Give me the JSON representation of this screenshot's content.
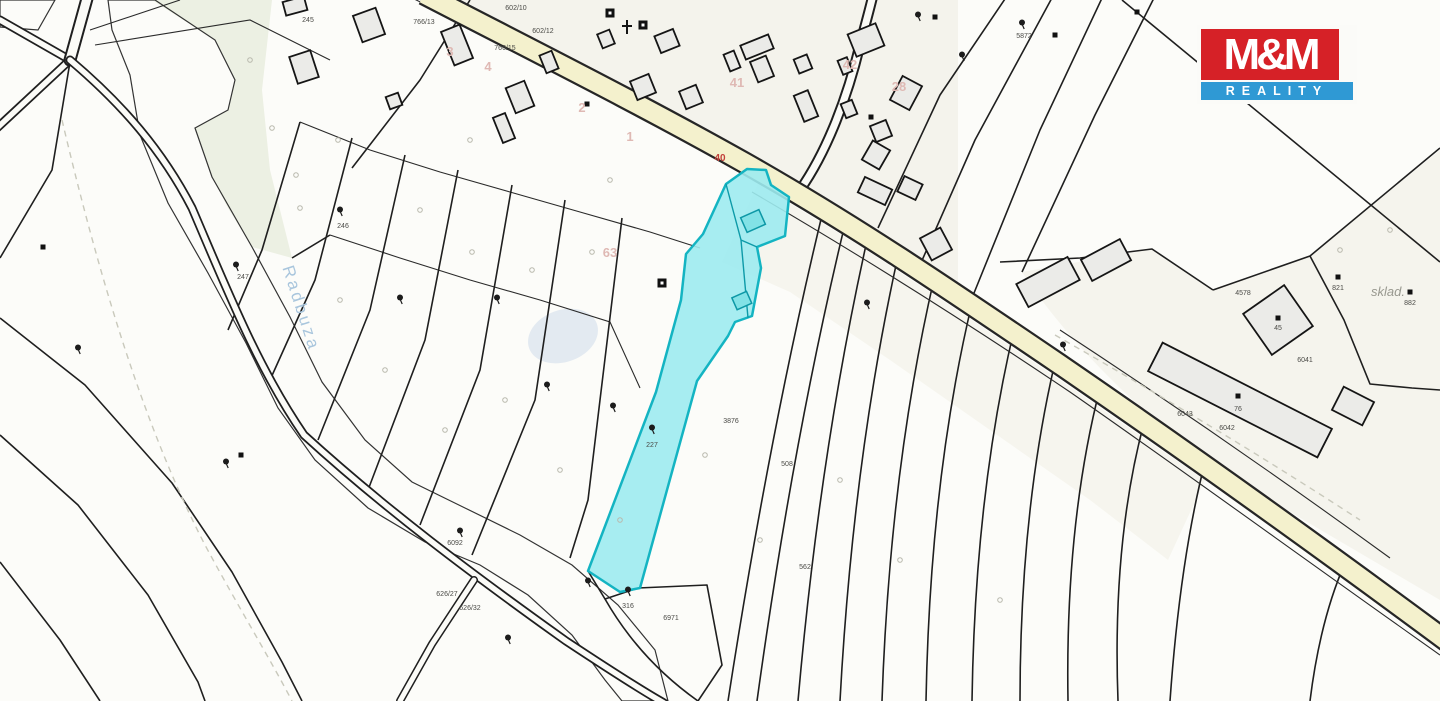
{
  "logo": {
    "top": "M&M",
    "bottom": "REALITY",
    "red": "#d62127",
    "blue": "#2f99d4"
  },
  "map": {
    "labels": {
      "river": "Radbuza",
      "warehouse": "sklad."
    },
    "colors": {
      "highlight_fill": "#9debef",
      "highlight_stroke": "#14b4c2",
      "river": "#d9e2eb",
      "road": "#f4f1cd"
    },
    "parcel_numbers": [
      {
        "t": "602/10",
        "x": 516,
        "y": 10
      },
      {
        "t": "602/12",
        "x": 543,
        "y": 33
      },
      {
        "t": "766/13",
        "x": 424,
        "y": 24
      },
      {
        "t": "766/15",
        "x": 505,
        "y": 50
      },
      {
        "t": "5872",
        "x": 1024,
        "y": 38
      },
      {
        "t": "4578",
        "x": 1243,
        "y": 295
      },
      {
        "t": "6041",
        "x": 1305,
        "y": 362
      },
      {
        "t": "6043",
        "x": 1185,
        "y": 416
      },
      {
        "t": "6042",
        "x": 1227,
        "y": 430
      },
      {
        "t": "3876",
        "x": 731,
        "y": 423
      },
      {
        "t": "508",
        "x": 787,
        "y": 466
      },
      {
        "t": "6092",
        "x": 455,
        "y": 545
      },
      {
        "t": "626/27",
        "x": 447,
        "y": 596
      },
      {
        "t": "626/32",
        "x": 470,
        "y": 610
      },
      {
        "t": "562",
        "x": 805,
        "y": 569
      },
      {
        "t": "6971",
        "x": 671,
        "y": 620
      },
      {
        "t": "227",
        "x": 652,
        "y": 447
      },
      {
        "t": "246",
        "x": 343,
        "y": 228
      },
      {
        "t": "247",
        "x": 243,
        "y": 279
      },
      {
        "t": "245",
        "x": 308,
        "y": 22
      },
      {
        "t": "821",
        "x": 1338,
        "y": 290
      },
      {
        "t": "882",
        "x": 1410,
        "y": 305
      },
      {
        "t": "76",
        "x": 1238,
        "y": 411
      },
      {
        "t": "45",
        "x": 1278,
        "y": 330
      },
      {
        "t": "316",
        "x": 628,
        "y": 608
      }
    ],
    "house_numbers": [
      {
        "t": "40",
        "x": 720,
        "y": 161,
        "c": "red"
      },
      {
        "t": "41",
        "x": 737,
        "y": 87,
        "c": "pink"
      },
      {
        "t": "42",
        "x": 850,
        "y": 69,
        "c": "pink"
      },
      {
        "t": "28",
        "x": 899,
        "y": 91,
        "c": "pink"
      },
      {
        "t": "3",
        "x": 450,
        "y": 56,
        "c": "pink"
      },
      {
        "t": "4",
        "x": 488,
        "y": 71,
        "c": "pink"
      },
      {
        "t": "2",
        "x": 582,
        "y": 112,
        "c": "pink"
      },
      {
        "t": "1",
        "x": 630,
        "y": 141,
        "c": "pink"
      },
      {
        "t": "63",
        "x": 610,
        "y": 257,
        "c": "pink"
      }
    ]
  }
}
